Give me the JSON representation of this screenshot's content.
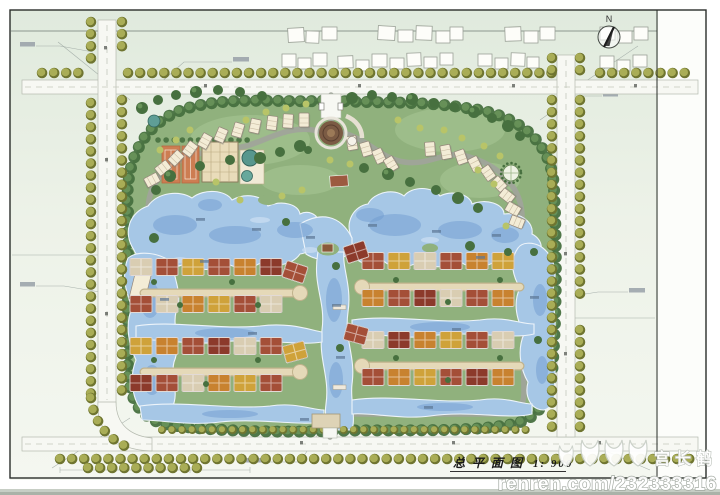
{
  "title_block": {
    "title": "总平面图",
    "scale": "1: 900"
  },
  "north": {
    "label": "N"
  },
  "watermark": {
    "name": "宫长鹤",
    "site": "renren.com/232333316"
  },
  "colors": {
    "water": "#a6c7e6",
    "deep_water": "#6f9cd0",
    "lawn": "#90b17d",
    "street_tree": "#a9ad56",
    "dense_tree": "#47703f",
    "roof_brick": "#a44f38",
    "roof_orange": "#c8822f",
    "roof_gold": "#cfa23a",
    "roof_maroon": "#8c3a2b",
    "roof_tan": "#d9cdb2",
    "building_cream": "#f3ecd6",
    "clubhouse": "#e9dcba",
    "tennis_court": "#cd7d52",
    "road": "#f7f8f3",
    "lane": "#e5d9b8",
    "paper_green": "#e6efe2"
  }
}
